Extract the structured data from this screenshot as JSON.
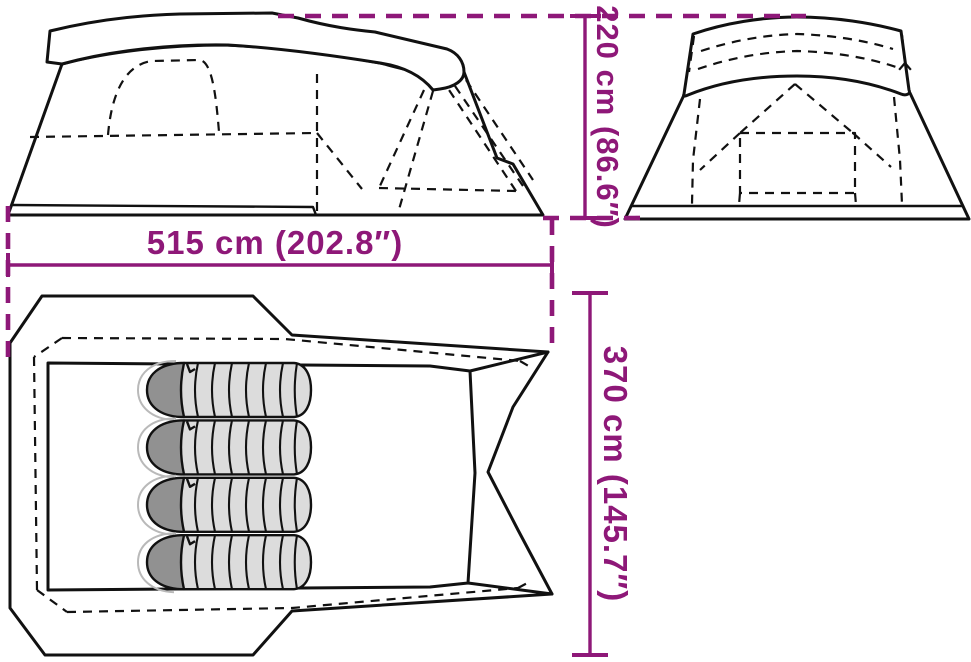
{
  "diagram": {
    "subject": "tent-dimensions-diagram",
    "sleeping_bag_count": 4
  },
  "dimensions": {
    "width": {
      "label": "515 cm (202.8″)",
      "value_cm": 515,
      "value_in": 202.8
    },
    "height": {
      "label": "220 cm (86.6″)",
      "value_cm": 220,
      "value_in": 86.6
    },
    "depth": {
      "label": "370 cm (145.7″)",
      "value_cm": 370,
      "value_in": 145.7
    }
  },
  "colors": {
    "accent": "#8e1878",
    "line": "#111111",
    "bag_body": "#dcdcdc",
    "bag_hood": "#919191",
    "background": "#ffffff"
  }
}
